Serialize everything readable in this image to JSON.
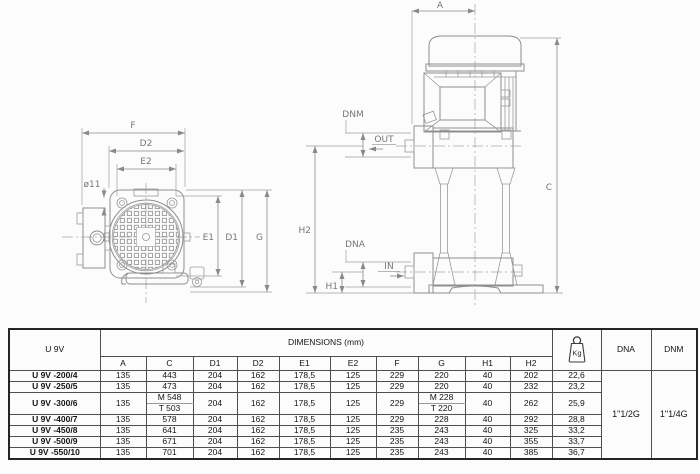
{
  "drawing": {
    "front_view": {
      "f": "F",
      "d2": "D2",
      "e2": "E2",
      "hole_dia": "ø11",
      "e1": "E1",
      "d1": "D1",
      "g": "G"
    },
    "side_view": {
      "a": "A",
      "c": "C",
      "h1": "H1",
      "h2": "H2",
      "dnm": "DNM",
      "out": "OUT",
      "dna": "DNA",
      "in": "IN"
    }
  },
  "table": {
    "model_header": "U 9V",
    "dimensions_header": "DIMENSIONS (mm)",
    "weight_unit": "Kg",
    "dna_header": "DNA",
    "dnm_header": "DNM",
    "dna_value": "1\"1/2G",
    "dnm_value": "1\"1/4G",
    "columns": [
      "A",
      "C",
      "D1",
      "D2",
      "E1",
      "E2",
      "F",
      "G",
      "H1",
      "H2"
    ],
    "rows": [
      {
        "model": "U 9V -200/4",
        "a": "135",
        "c": "443",
        "d1": "204",
        "d2": "162",
        "e1": "178,5",
        "e2": "125",
        "f": "229",
        "g": "220",
        "h1": "40",
        "h2": "202",
        "kg": "22,6"
      },
      {
        "model": "U 9V -250/5",
        "a": "135",
        "c": "473",
        "d1": "204",
        "d2": "162",
        "e1": "178,5",
        "e2": "125",
        "f": "229",
        "g": "220",
        "h1": "40",
        "h2": "232",
        "kg": "23,2"
      },
      {
        "model": "U 9V -300/6",
        "a": "135",
        "c_m": "M 548",
        "c_t": "T 503",
        "d1": "204",
        "d2": "162",
        "e1": "178,5",
        "e2": "125",
        "f": "229",
        "g_m": "M 228",
        "g_t": "T 220",
        "h1": "40",
        "h2": "262",
        "kg": "25,9"
      },
      {
        "model": "U 9V -400/7",
        "a": "135",
        "c": "578",
        "d1": "204",
        "d2": "162",
        "e1": "178,5",
        "e2": "125",
        "f": "229",
        "g": "228",
        "h1": "40",
        "h2": "292",
        "kg": "28,8"
      },
      {
        "model": "U 9V -450/8",
        "a": "135",
        "c": "641",
        "d1": "204",
        "d2": "162",
        "e1": "178,5",
        "e2": "125",
        "f": "235",
        "g": "243",
        "h1": "40",
        "h2": "325",
        "kg": "33,2"
      },
      {
        "model": "U 9V -500/9",
        "a": "135",
        "c": "671",
        "d1": "204",
        "d2": "162",
        "e1": "178,5",
        "e2": "125",
        "f": "235",
        "g": "243",
        "h1": "40",
        "h2": "355",
        "kg": "33,7"
      },
      {
        "model": "U 9V -550/10",
        "a": "135",
        "c": "701",
        "d1": "204",
        "d2": "162",
        "e1": "178,5",
        "e2": "125",
        "f": "235",
        "g": "243",
        "h1": "40",
        "h2": "385",
        "kg": "36,7"
      }
    ]
  }
}
